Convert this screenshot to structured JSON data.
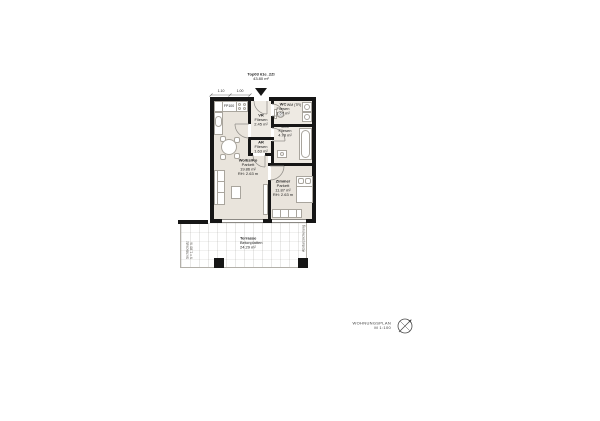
{
  "plan": {
    "title": {
      "unit": "Top03 61e_2Zi",
      "area": "43.80 m²"
    },
    "rooms": {
      "vr": {
        "name": "VR",
        "floor": "Fliesen",
        "area": "2.45 m²"
      },
      "wc": {
        "name": "WC",
        "floor": "Fliesen",
        "area": "1.67 m²",
        "appliances": "WM (TR)"
      },
      "bad": {
        "name": "Bad",
        "floor": "Fliesen",
        "area": "4.78 m²"
      },
      "ar": {
        "name": "AR",
        "floor": "Fliesen",
        "area": "1.63 m²"
      },
      "wohnen": {
        "name": "Wo/Es/Ko",
        "floor": "Parkett",
        "area": "19.86 m²",
        "rh": "RH: 2.63 m"
      },
      "zimmer": {
        "name": "Zimmer",
        "floor": "Parkett",
        "area": "11.87 m²",
        "rh": "RH: 2.63 m"
      },
      "terrasse": {
        "name": "Terrasse",
        "floor": "Betonplatten",
        "area": "24.29 m²"
      }
    },
    "kitchen": {
      "unit_label": "FP100"
    },
    "dimensions": {
      "d1": "1.10",
      "d2": "1.00"
    },
    "annotations": {
      "left_line1": "Sichtschutz",
      "left_line2": "h = 1.80 m",
      "right": "Absturzsicherung"
    }
  },
  "legend": {
    "title": "WOHNUNGSPLAN",
    "scale": "M 1:100",
    "icon": "north-arrow-icon"
  },
  "colors": {
    "wall": "#161616",
    "floor_parkett": "#e9e4dc",
    "floor_fliesen": "#eeeae3",
    "furniture_line": "#a9a59d",
    "terrace_line": "#b3b0a9"
  }
}
